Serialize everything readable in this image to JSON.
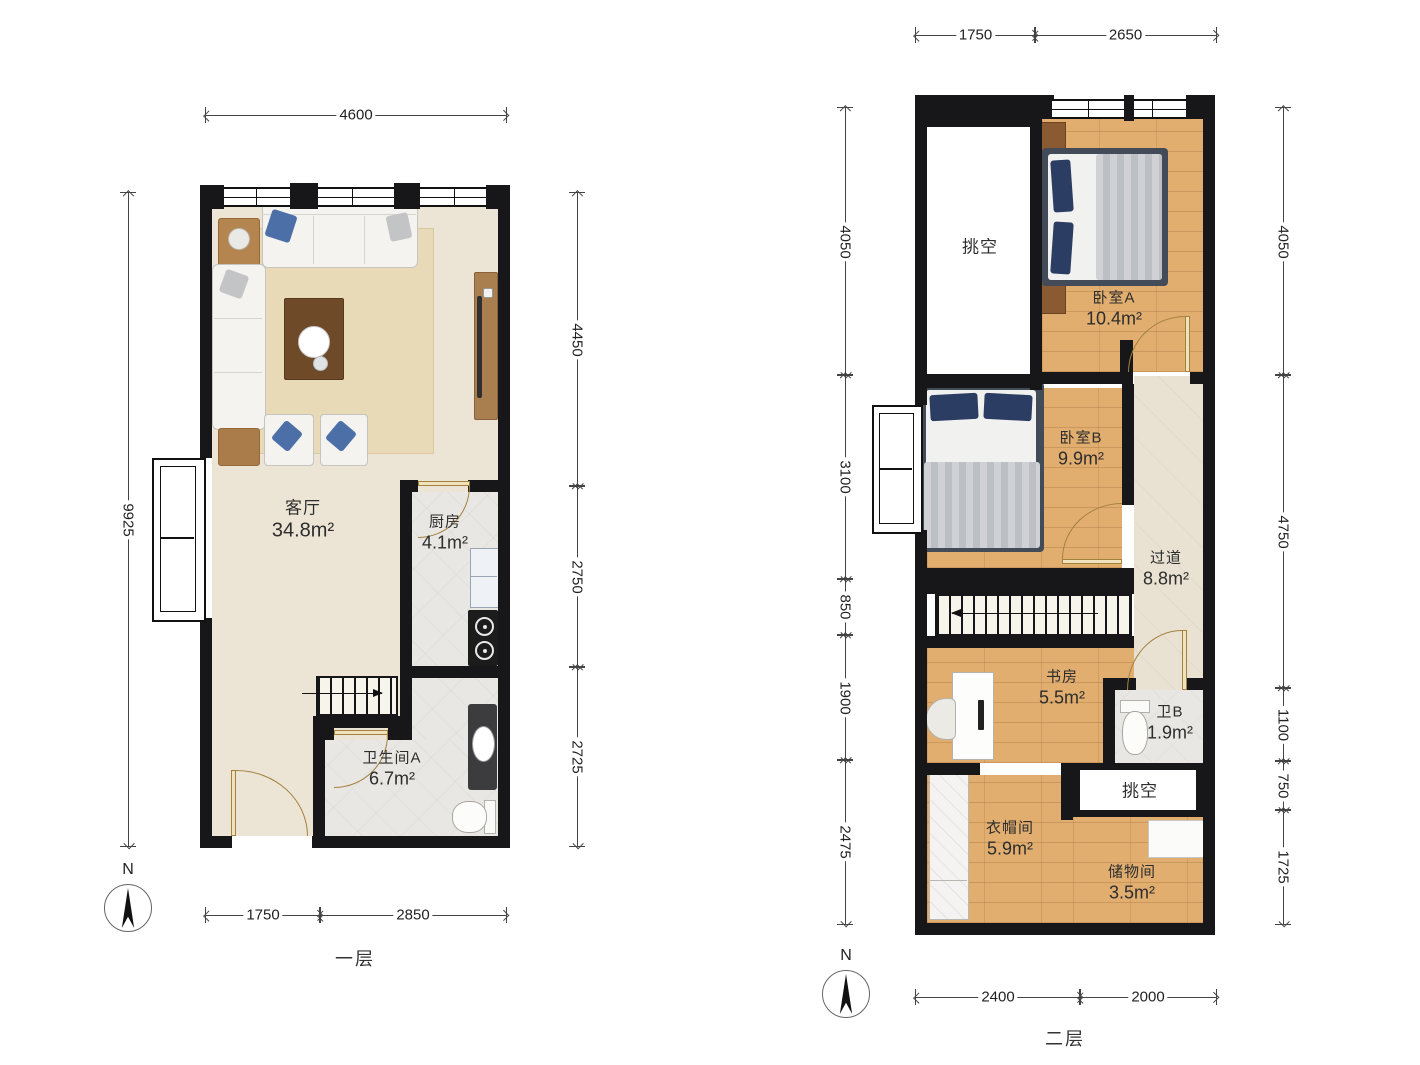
{
  "palette": {
    "wall": "#17171a",
    "wood_floor": "#e1ae70",
    "living_floor": "#ece5d5",
    "tile_floor": "#e9e7e3",
    "corridor_floor": "#e9e2d3",
    "rug": "#e8dab6",
    "door": "#a3813f",
    "dimension": "#444444",
    "pillow_blue": "#4d6fa8",
    "pillow_navy": "#2c3d63"
  },
  "floor1": {
    "title": "一层",
    "compass": "N",
    "rooms": {
      "living": {
        "name": "客厅",
        "area": "34.8m²"
      },
      "kitchen": {
        "name": "厨房",
        "area": "4.1m²"
      },
      "bathA": {
        "name": "卫生间A",
        "area": "6.7m²"
      }
    },
    "dims": {
      "top": [
        "4600"
      ],
      "left": [
        "9925"
      ],
      "right": [
        "4450",
        "2750",
        "2725"
      ],
      "bottom": [
        "1750",
        "2850"
      ]
    }
  },
  "floor2": {
    "title": "二层",
    "compass": "N",
    "rooms": {
      "voidTop": {
        "name": "挑空"
      },
      "bedroomA": {
        "name": "卧室A",
        "area": "10.4m²"
      },
      "bedroomB": {
        "name": "卧室B",
        "area": "9.9m²"
      },
      "corridor": {
        "name": "过道",
        "area": "8.8m²"
      },
      "study": {
        "name": "书房",
        "area": "5.5m²"
      },
      "bathB": {
        "name": "卫B",
        "area": "1.9m²"
      },
      "voidSmall": {
        "name": "挑空"
      },
      "cloakroom": {
        "name": "衣帽间",
        "area": "5.9m²"
      },
      "storage": {
        "name": "储物间",
        "area": "3.5m²"
      }
    },
    "dims": {
      "top": [
        "1750",
        "2650"
      ],
      "left": [
        "4050",
        "3100",
        "850",
        "1900",
        "2475"
      ],
      "right": [
        "4050",
        "4750",
        "1100",
        "750",
        "1725"
      ],
      "bottom": [
        "2400",
        "2000"
      ]
    }
  }
}
